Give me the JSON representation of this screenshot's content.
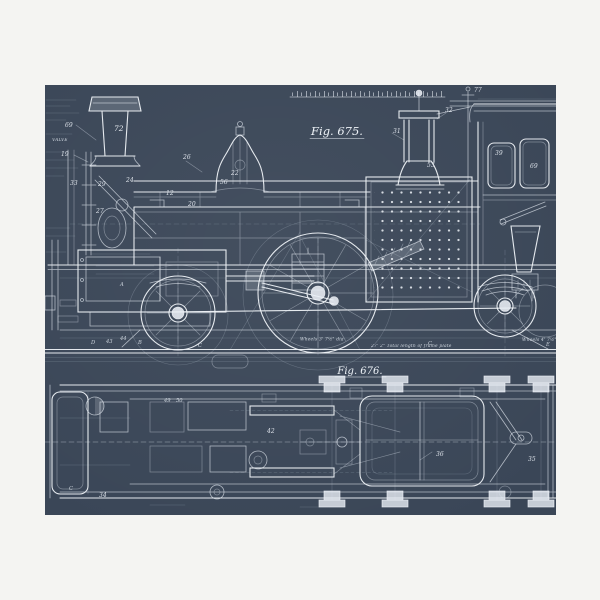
{
  "photo": {
    "matte_color": "#f4f4f2",
    "blueprint_bg": "#3a4657",
    "line_color": "#e8edf4",
    "subject": "steam locomotive engineering blueprint, side elevation and plan"
  },
  "figures": {
    "fig675": {
      "label": "Fig. 675."
    },
    "fig676": {
      "label": "Fig. 676."
    }
  },
  "annotations": [
    {
      "t": "Wheels 3' 7½\" dia",
      "x": 300,
      "y": 340.5
    },
    {
      "t": "27' 2\"  Total length of frame plate",
      "x": 371,
      "y": 347
    },
    {
      "t": "Wheels 4' 7½\" dia",
      "x": 522,
      "y": 341
    },
    {
      "t": "VALVE",
      "x": 52,
      "y": 141
    }
  ],
  "part_labels": [
    {
      "t": "72",
      "x": 114,
      "y": 131,
      "cls": "plbl-big"
    },
    {
      "t": "77",
      "x": 474,
      "y": 92
    },
    {
      "t": "26",
      "x": 183,
      "y": 159
    },
    {
      "t": "12",
      "x": 166,
      "y": 195
    },
    {
      "t": "20",
      "x": 188,
      "y": 206
    },
    {
      "t": "29",
      "x": 98,
      "y": 186
    },
    {
      "t": "33",
      "x": 70,
      "y": 185
    },
    {
      "t": "19",
      "x": 61,
      "y": 156
    },
    {
      "t": "69",
      "x": 65,
      "y": 127
    },
    {
      "t": "56",
      "x": 220,
      "y": 184
    },
    {
      "t": "22",
      "x": 231,
      "y": 175
    },
    {
      "t": "24",
      "x": 126,
      "y": 182
    },
    {
      "t": "27",
      "x": 96,
      "y": 213
    },
    {
      "t": "31",
      "x": 393,
      "y": 133
    },
    {
      "t": "32",
      "x": 445,
      "y": 112
    },
    {
      "t": "53",
      "x": 427,
      "y": 167
    },
    {
      "t": "39",
      "x": 495,
      "y": 155
    },
    {
      "t": "69",
      "x": 530,
      "y": 168
    },
    {
      "t": "49",
      "x": 164,
      "y": 402,
      "cls": "plbl-sm"
    },
    {
      "t": "50",
      "x": 176,
      "y": 402,
      "cls": "plbl-sm"
    },
    {
      "t": "42",
      "x": 267,
      "y": 433
    },
    {
      "t": "36",
      "x": 436,
      "y": 456
    },
    {
      "t": "35",
      "x": 528,
      "y": 461
    },
    {
      "t": "34",
      "x": 99,
      "y": 497
    },
    {
      "t": "43",
      "x": 106,
      "y": 343,
      "cls": "plbl-sm"
    },
    {
      "t": "44",
      "x": 120,
      "y": 340,
      "cls": "plbl-sm"
    },
    {
      "t": "A",
      "x": 120,
      "y": 286,
      "cls": "plbl-sm"
    },
    {
      "t": "B",
      "x": 138,
      "y": 344,
      "cls": "plbl-sm"
    },
    {
      "t": "D",
      "x": 91,
      "y": 344,
      "cls": "plbl-sm"
    },
    {
      "t": "C",
      "x": 69,
      "y": 490,
      "cls": "plbl-sm"
    },
    {
      "t": "C",
      "x": 198,
      "y": 347,
      "cls": "plbl-sm"
    },
    {
      "t": "C",
      "x": 428,
      "y": 345,
      "cls": "plbl-sm"
    },
    {
      "t": "E",
      "x": 546,
      "y": 346,
      "cls": "plbl-sm"
    }
  ]
}
